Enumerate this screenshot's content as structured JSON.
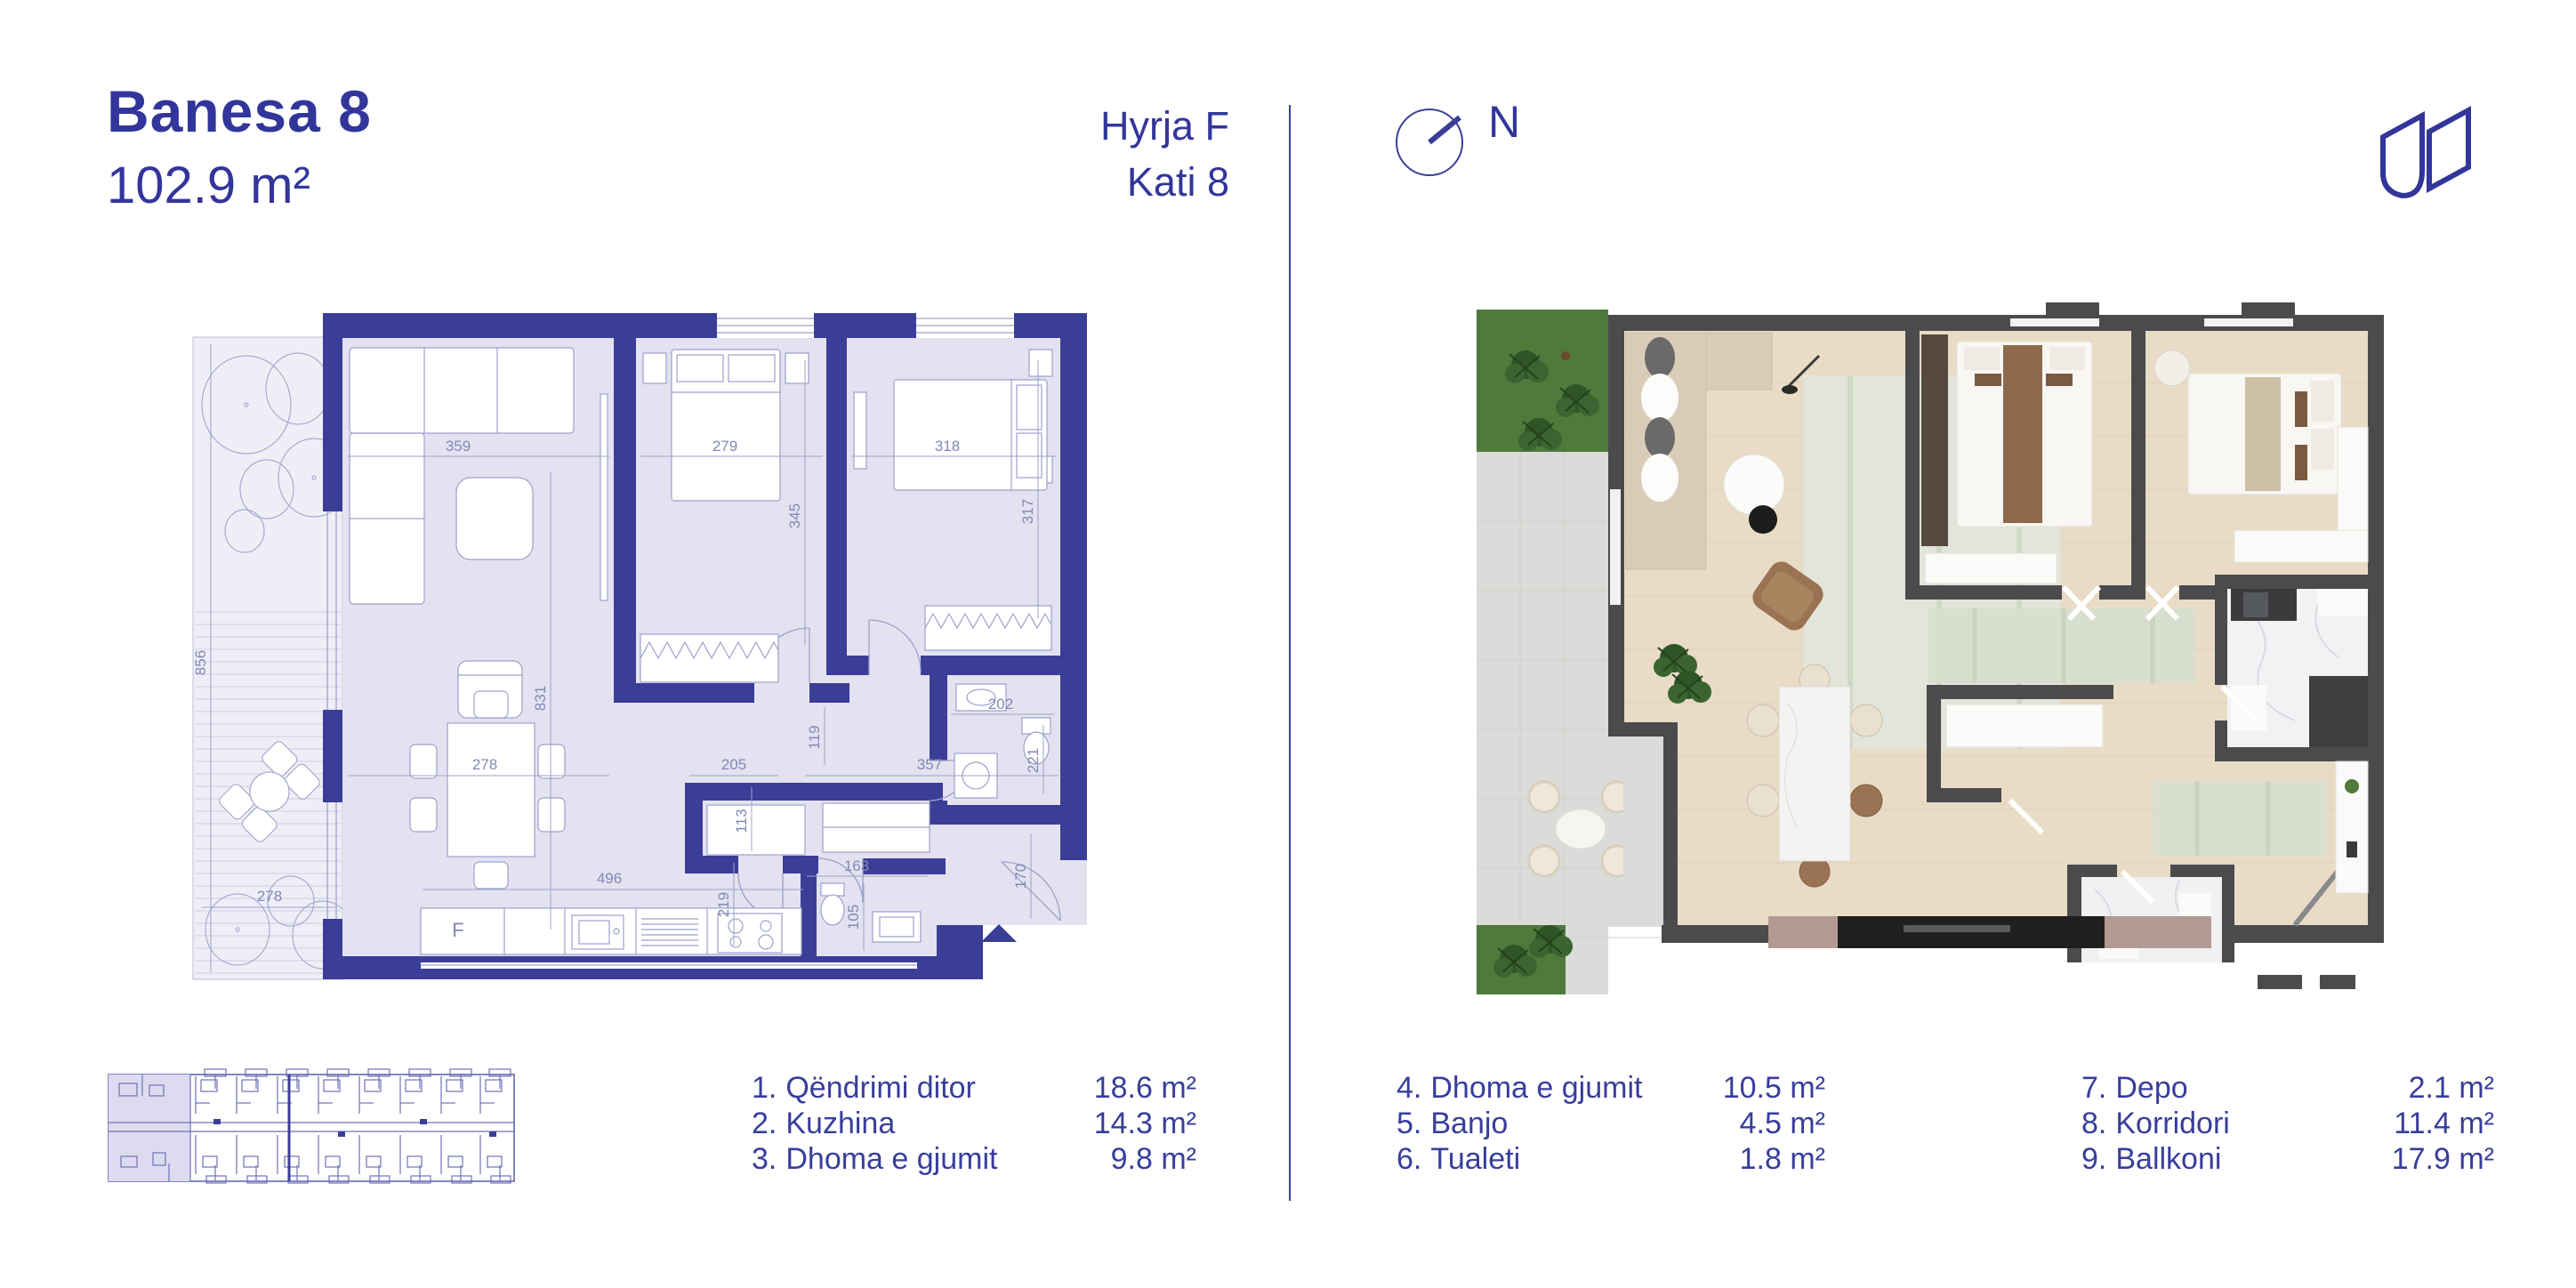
{
  "header": {
    "title": "Banesa 8",
    "area": "102.9 m²",
    "entry": "Hyrja F",
    "floor": "Kati 8",
    "north_label": "N"
  },
  "colors": {
    "brand_blue": "#32369B",
    "wall_blue": "#3B3E96",
    "room_fill": "#E4E2F0",
    "balcony_fill": "#EFEEF7",
    "dimension_text": "#8388B4",
    "render_wall": "#4B4B4D",
    "wood_floor": "#E9DCC6",
    "tile": "#DBDBD9",
    "grass": "#4E7A3C"
  },
  "left_plan": {
    "fridge_label": "F",
    "dims": [
      "359",
      "279",
      "318",
      "345",
      "317",
      "856",
      "831",
      "119",
      "202",
      "221",
      "278",
      "113",
      "205",
      "357",
      "496",
      "219",
      "163",
      "105",
      "170",
      "278"
    ]
  },
  "legend": {
    "items": [
      {
        "num": "1.",
        "name": "Qëndrimi ditor",
        "area": "18.6 m²"
      },
      {
        "num": "2.",
        "name": "Kuzhina",
        "area": "14.3 m²"
      },
      {
        "num": "3.",
        "name": "Dhoma e gjumit",
        "area": "9.8 m²"
      },
      {
        "num": "4.",
        "name": "Dhoma e gjumit",
        "area": "10.5 m²"
      },
      {
        "num": "5.",
        "name": "Banjo",
        "area": "4.5 m²"
      },
      {
        "num": "6.",
        "name": "Tualeti",
        "area": "1.8 m²"
      },
      {
        "num": "7.",
        "name": "Depo",
        "area": "2.1 m²"
      },
      {
        "num": "8.",
        "name": "Korridori",
        "area": "11.4 m²"
      },
      {
        "num": "9.",
        "name": "Ballkoni",
        "area": "17.9 m²"
      }
    ]
  }
}
